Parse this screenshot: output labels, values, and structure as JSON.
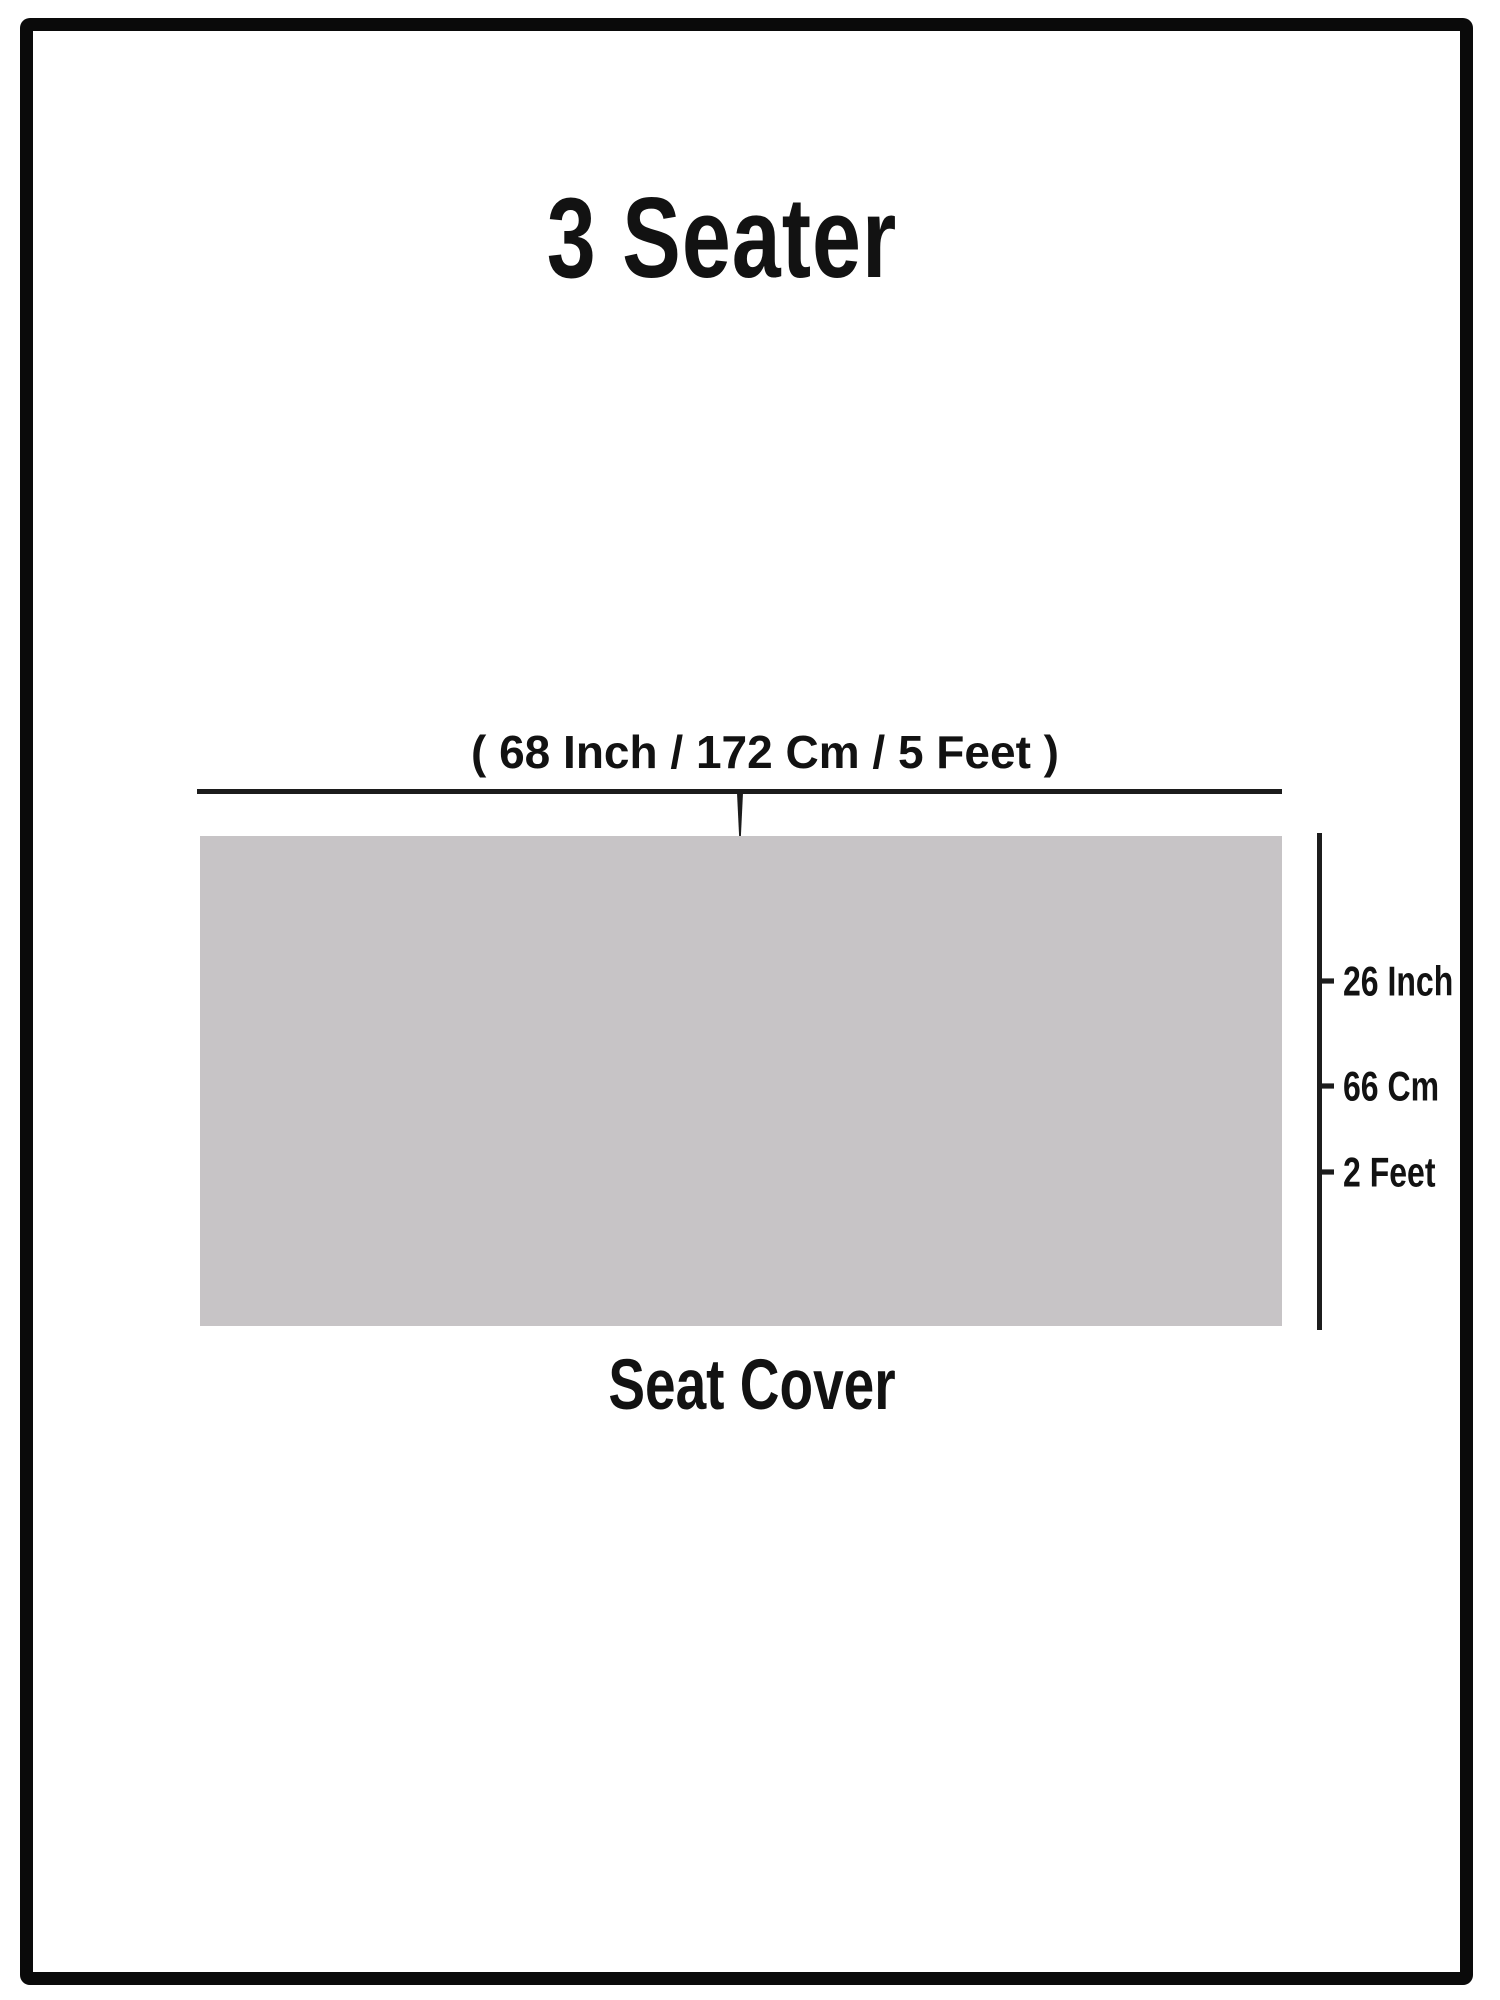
{
  "diagram": {
    "title": "3 Seater",
    "product_label": "Seat Cover",
    "width_dimension": {
      "label": "( 68 Inch / 172 Cm / 5 Feet )",
      "inch": "68 Inch",
      "cm": "172 Cm",
      "feet": "5 Feet"
    },
    "height_dimension": {
      "labels": [
        "26 Inch",
        "66 Cm",
        "2 Feet"
      ]
    },
    "colors": {
      "background": "#ffffff",
      "frame": "#0a0a0a",
      "line": "#1c1c1c",
      "text": "#121212",
      "seat_fill": "#c7c4c6"
    }
  }
}
